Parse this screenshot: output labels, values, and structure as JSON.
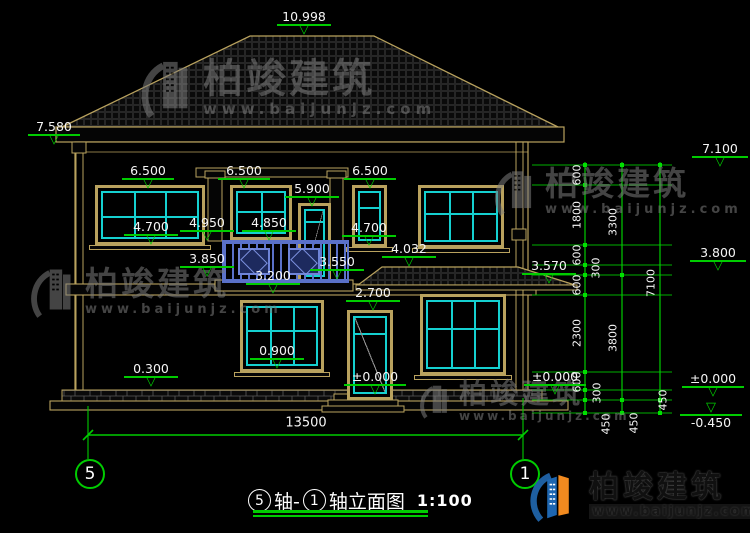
{
  "title": {
    "axis_from": "5",
    "joiner": "轴-",
    "axis_to": "1",
    "tail": "轴立面图",
    "scale": "1:100"
  },
  "axis_bubbles": {
    "left": "5",
    "right": "1"
  },
  "brand": {
    "name": "柏竣建筑",
    "url": "www.baijunjz.com"
  },
  "markers": [
    {
      "id": "ridge",
      "v": "10.998"
    },
    {
      "id": "left-eave",
      "v": "7.580"
    },
    {
      "id": "w1-top",
      "v": "6.500"
    },
    {
      "id": "w2-top",
      "v": "6.500"
    },
    {
      "id": "w3-top",
      "v": "6.500"
    },
    {
      "id": "balcony-door-top",
      "v": "5.900"
    },
    {
      "id": "w1-sill",
      "v": "4.700"
    },
    {
      "id": "railing-top",
      "v": "4.950"
    },
    {
      "id": "w2-sill",
      "v": "4.850"
    },
    {
      "id": "w3-sill",
      "v": "4.700"
    },
    {
      "id": "porch-roof-top",
      "v": "4.032"
    },
    {
      "id": "balcony-slab",
      "v": "3.850"
    },
    {
      "id": "balcony-slab-rt",
      "v": "3.550"
    },
    {
      "id": "floor-2",
      "v": "3.200"
    },
    {
      "id": "porch-eave",
      "v": "3.570"
    },
    {
      "id": "door1-top",
      "v": "2.700"
    },
    {
      "id": "w5-sill",
      "v": "0.900"
    },
    {
      "id": "plinth-top",
      "v": "0.300"
    },
    {
      "id": "entry-level",
      "v": "±0.000"
    },
    {
      "id": "right-ground",
      "v": "±0.000"
    },
    {
      "id": "right-wall-top",
      "v": "7.100"
    },
    {
      "id": "right-mid",
      "v": "3.800"
    },
    {
      "id": "right-zero",
      "v": "±0.000"
    },
    {
      "id": "footing",
      "v": "-0.450"
    }
  ],
  "dims": {
    "total_width": "13500",
    "chain_inner": [
      "600",
      "1800",
      "600",
      "300",
      "600",
      "2300",
      "600",
      "300",
      "450"
    ],
    "chain_mid": [
      "3300",
      "3800",
      "450"
    ],
    "chain_outer": [
      "7100",
      "450"
    ]
  },
  "colors": {
    "line_tan": "#B9A25E",
    "cad_green": "#00CC00",
    "window_cyan": "#15D0D0",
    "railing_blue": "#5A71C9",
    "logo_blue": "#1E66B0",
    "logo_orange": "#F28A1F"
  }
}
